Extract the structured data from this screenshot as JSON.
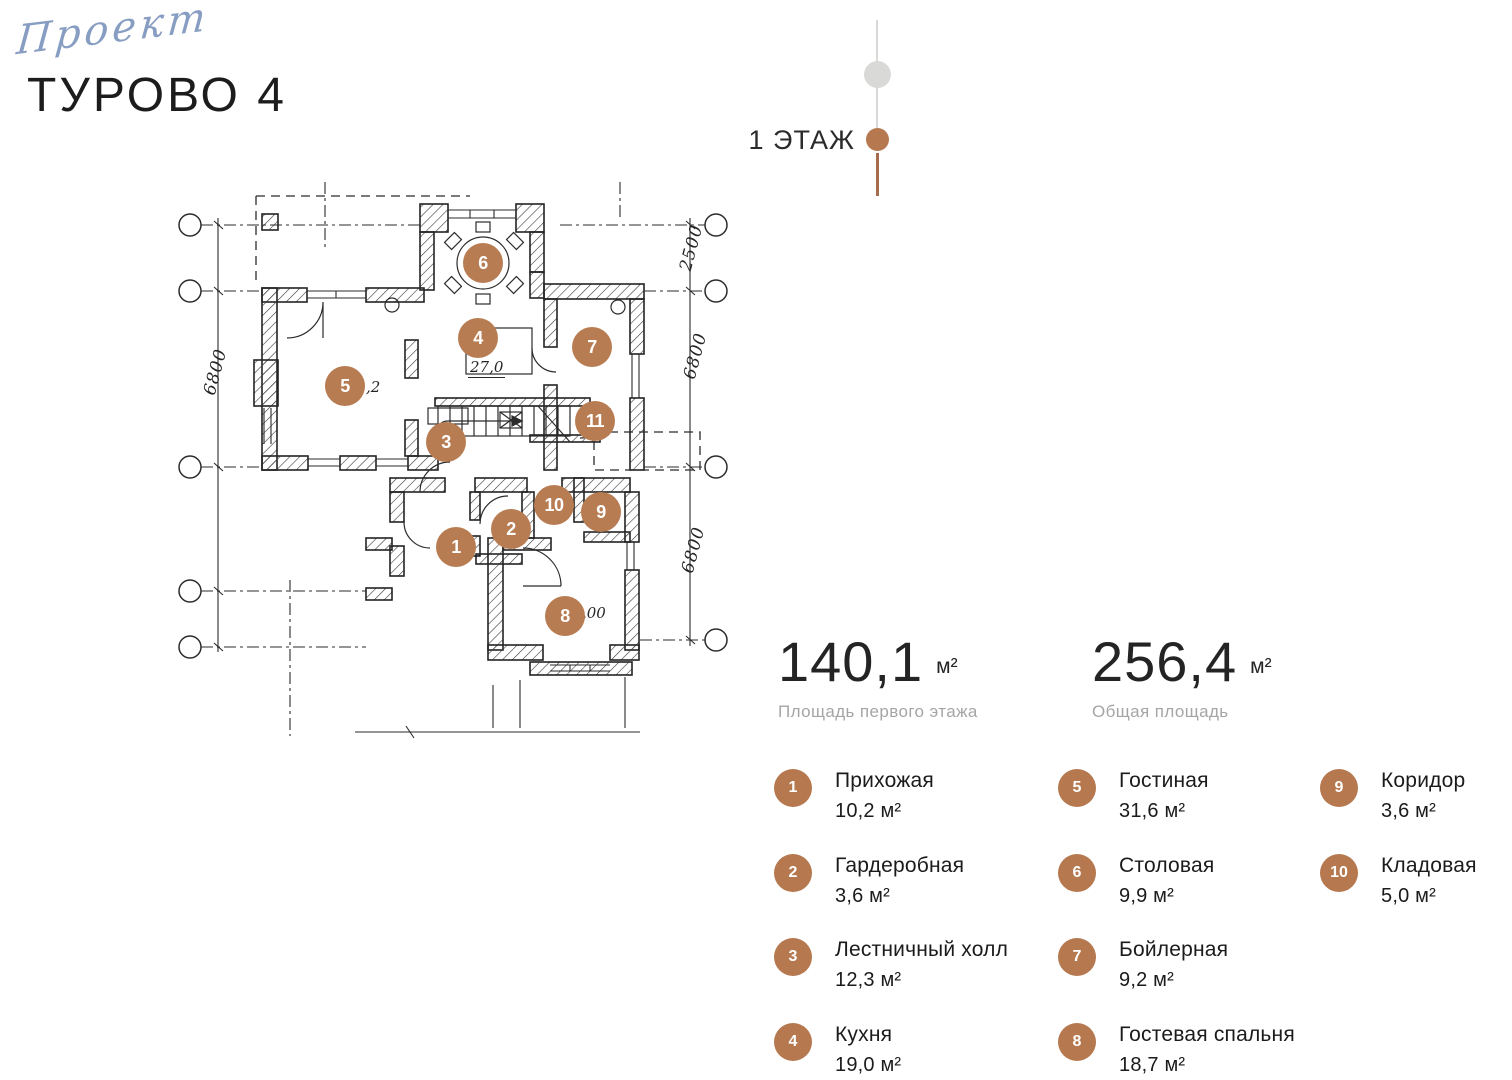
{
  "header": {
    "logo_script": "Проект",
    "title": "ТУРОВО 4"
  },
  "floor_indicator": {
    "label": "1 ЭТАЖ"
  },
  "stats": {
    "first_floor": {
      "value": "140,1",
      "unit": "м²",
      "label": "Площадь первого этажа"
    },
    "total": {
      "value": "256,4",
      "unit": "м²",
      "label": "Общая площадь"
    }
  },
  "plan": {
    "markers": [
      {
        "num": "1",
        "x": 286,
        "y": 367
      },
      {
        "num": "2",
        "x": 341,
        "y": 349
      },
      {
        "num": "3",
        "x": 276,
        "y": 262
      },
      {
        "num": "4",
        "x": 308,
        "y": 158
      },
      {
        "num": "5",
        "x": 175,
        "y": 206
      },
      {
        "num": "6",
        "x": 313,
        "y": 83
      },
      {
        "num": "7",
        "x": 422,
        "y": 167
      },
      {
        "num": "8",
        "x": 395,
        "y": 436
      },
      {
        "num": "9",
        "x": 431,
        "y": 332
      },
      {
        "num": "10",
        "x": 384,
        "y": 325
      },
      {
        "num": "11",
        "x": 425,
        "y": 241
      }
    ],
    "dimensions": [
      {
        "text": "6800"
      },
      {
        "text": "2500"
      },
      {
        "text": "6800"
      },
      {
        "text": "6800"
      }
    ],
    "annotations": [
      {
        "text": "27,0"
      },
      {
        "text": ",2"
      },
      {
        "text": ",00"
      }
    ]
  },
  "legend": {
    "items": [
      {
        "num": "1",
        "name": "Прихожая",
        "area": "10,2 м²"
      },
      {
        "num": "2",
        "name": "Гардеробная",
        "area": "3,6 м²"
      },
      {
        "num": "3",
        "name": "Лестничный холл",
        "area": "12,3 м²"
      },
      {
        "num": "4",
        "name": "Кухня",
        "area": "19,0 м²"
      },
      {
        "num": "5",
        "name": "Гостиная",
        "area": "31,6 м²"
      },
      {
        "num": "6",
        "name": "Столовая",
        "area": "9,9 м²"
      },
      {
        "num": "7",
        "name": "Бойлерная",
        "area": "9,2 м²"
      },
      {
        "num": "8",
        "name": "Гостевая спальня",
        "area": "18,7 м²"
      },
      {
        "num": "9",
        "name": "Коридор",
        "area": "3,6 м²"
      },
      {
        "num": "10",
        "name": "Кладовая",
        "area": "5,0 м²"
      }
    ]
  },
  "colors": {
    "accent": "#b5784f",
    "grey": "#d9d9d7",
    "ink": "#1d1d1d",
    "label_grey": "#a5a5a5"
  }
}
